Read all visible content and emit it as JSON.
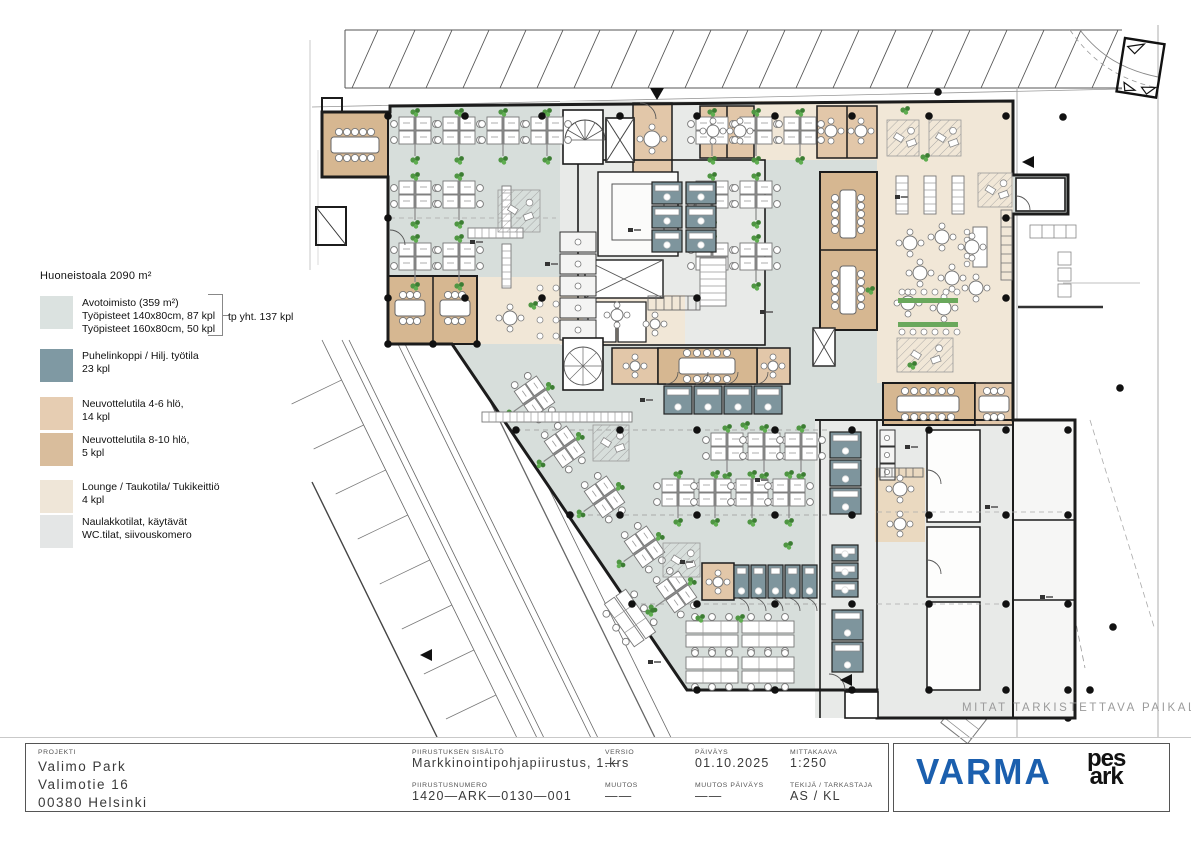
{
  "legend": {
    "title": "Huoneistoala 2090 m²",
    "items": [
      {
        "color": "#dbe2e0",
        "lines": [
          "Avotoimisto (359 m²)",
          "Työpisteet 140x80cm, 87 kpl",
          "Työpisteet 160x80cm, 50 kpl"
        ],
        "annotation": "tp yht. 137 kpl"
      },
      {
        "color": "#7f99a3",
        "lines": [
          "Puhelinkoppi / Hilj. työtila",
          "23 kpl"
        ]
      },
      {
        "color": "#e6cdb2",
        "lines": [
          "Neuvottelutila 4-6 hlö,",
          "14 kpl"
        ]
      },
      {
        "color": "#d9bd9c",
        "lines": [
          "Neuvottelutila 8-10 hlö,",
          "5 kpl"
        ]
      },
      {
        "color": "#efe6d8",
        "lines": [
          "Lounge / Taukotila/ Tukikeittiö",
          "4 kpl"
        ]
      },
      {
        "color": "#e4e6e6",
        "lines": [
          "Naulakkotilat, käytävät",
          "WC.tilat, siivouskomero"
        ]
      }
    ]
  },
  "plan": {
    "watermark": "MITAT TARKISTETTAVA PAIKALTA"
  },
  "titleblock": {
    "project": {
      "label": "PROJEKTI",
      "line1": "Valimo Park",
      "line2": "Valimotie 16",
      "line3": "00380 Helsinki"
    },
    "fields": [
      {
        "label": "PIIRUSTUKSEN SISÄLTÖ",
        "value": "Markkinointipohjapiirustus, 1.krs"
      },
      {
        "label": "VERSIO",
        "value": "—"
      },
      {
        "label": "PÄIVÄYS",
        "value": "01.10.2025"
      },
      {
        "label": "MITTAKAAVA",
        "value": "1:250"
      },
      {
        "label": "PIIRUSTUSNUMERO",
        "value": "1420—ARK—0130—001"
      },
      {
        "label": "MUUTOS",
        "value": "——"
      },
      {
        "label": "MUUTOS PÄIVÄYS",
        "value": "——"
      },
      {
        "label": "TEKIJÄ / TARKASTAJA",
        "value": "AS / KL"
      }
    ],
    "logos": {
      "varma": "VARMA",
      "pesark_top": "pes",
      "pesark_bottom": "ark"
    }
  },
  "colors": {
    "open_office": "#d7dedb",
    "corridor": "#e8eae8",
    "lounge": "#f1e7d7",
    "meeting_small": "#e2c7a9",
    "meeting_large": "#d6b791",
    "phone_booth": "#7e959d",
    "varma_blue": "#1b5fae",
    "wall": "#1c1c1c"
  }
}
